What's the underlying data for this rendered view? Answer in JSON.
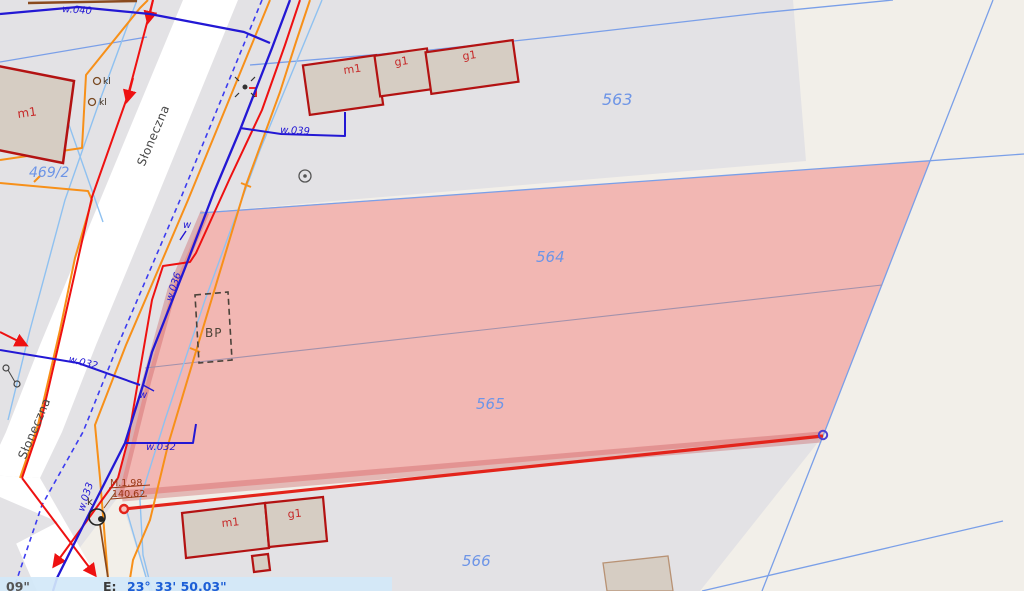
{
  "app": {
    "type": "cadastral-map-viewer"
  },
  "statusbar": {
    "lat_partial": "09\"",
    "lon_prefix": "E:",
    "lon_value": "23° 33' 50.03\""
  },
  "streets": [
    {
      "name": "Słoneczna"
    },
    {
      "name": "Słoneczna"
    }
  ],
  "parcels": [
    {
      "number": "563",
      "selected": false
    },
    {
      "number": "564",
      "selected": true
    },
    {
      "number": "565",
      "selected": true
    },
    {
      "number": "566",
      "selected": false
    },
    {
      "number": "469/2",
      "selected": false
    }
  ],
  "buildings": [
    {
      "label": "m1"
    },
    {
      "label": "m1"
    },
    {
      "label": "g1"
    },
    {
      "label": "g1"
    },
    {
      "label": "m1"
    },
    {
      "label": "g1"
    }
  ],
  "utilities": {
    "water_labels": [
      {
        "text": "w.040"
      },
      {
        "text": "w.039"
      },
      {
        "text": "w.036"
      },
      {
        "text": "w.032"
      },
      {
        "text": "w.032"
      },
      {
        "text": "w.033"
      },
      {
        "text": "w"
      },
      {
        "text": "w"
      }
    ]
  },
  "points": [
    {
      "text": "kl"
    },
    {
      "text": "kl"
    },
    {
      "text": "k"
    },
    {
      "text": "BP"
    }
  ],
  "measurements": [
    {
      "text": "M.1,98"
    },
    {
      "text": "140,62"
    }
  ],
  "colors": {
    "background": "#f2efe9",
    "parcel_gray": "#e3e2e5",
    "road_white": "#ffffff",
    "selection_pink": "#f2b7b3",
    "selection_border": "rgba(196,75,80,0.33)",
    "selection_red_line": "#e3241b",
    "boundary_blue": "#7a9fe8",
    "boundary_light": "#8fc1f0",
    "internal_boundary": "#a391ab",
    "water_blue": "#2318d4",
    "dashed_blue": "#3c3cf0",
    "orange": "#f79019",
    "red_line": "#ee1111",
    "brown": "#8a4a1e",
    "building_fill": "#d6cdc3",
    "building_outline": "#b31212",
    "label_blue": "#6e95e6",
    "label_red": "#c62828",
    "label_dark": "#474747",
    "measure_brown": "#993614"
  }
}
